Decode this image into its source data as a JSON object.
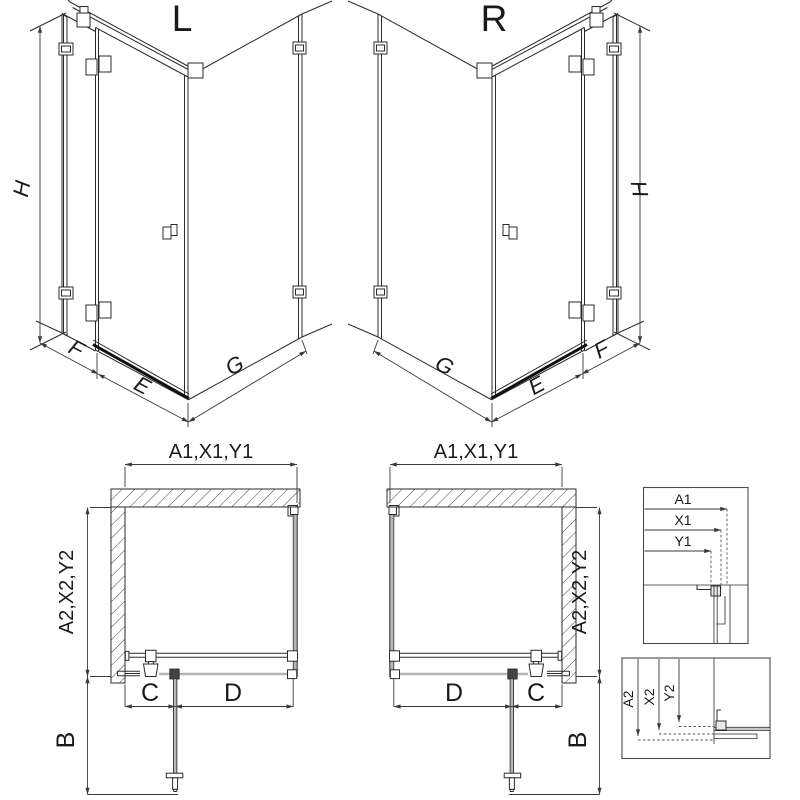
{
  "drawing": {
    "iso_left": {
      "title": "L",
      "dim_h": "H",
      "dim_f": "F",
      "dim_e": "E",
      "dim_g": "G"
    },
    "iso_right": {
      "title": "R",
      "dim_h": "H",
      "dim_f": "F",
      "dim_e": "E",
      "dim_g": "G"
    },
    "plan_left": {
      "dim_width": "A1,X1,Y1",
      "dim_depth": "A2,X2,Y2",
      "dim_c": "C",
      "dim_d": "D",
      "dim_b": "B"
    },
    "plan_right": {
      "dim_width": "A1,X1,Y1",
      "dim_depth": "A2,X2,Y2",
      "dim_c": "C",
      "dim_d": "D",
      "dim_b": "B"
    },
    "detail_width": {
      "dim_a1": "A1",
      "dim_x1": "X1",
      "dim_y1": "Y1"
    },
    "detail_depth": {
      "dim_a2": "A2",
      "dim_x2": "X2",
      "dim_y2": "Y2"
    },
    "colors": {
      "line": "#2b2b2b",
      "glass_gray": "#b5b5b5",
      "dimension": "#3a3a3a",
      "background": "#ffffff"
    }
  }
}
